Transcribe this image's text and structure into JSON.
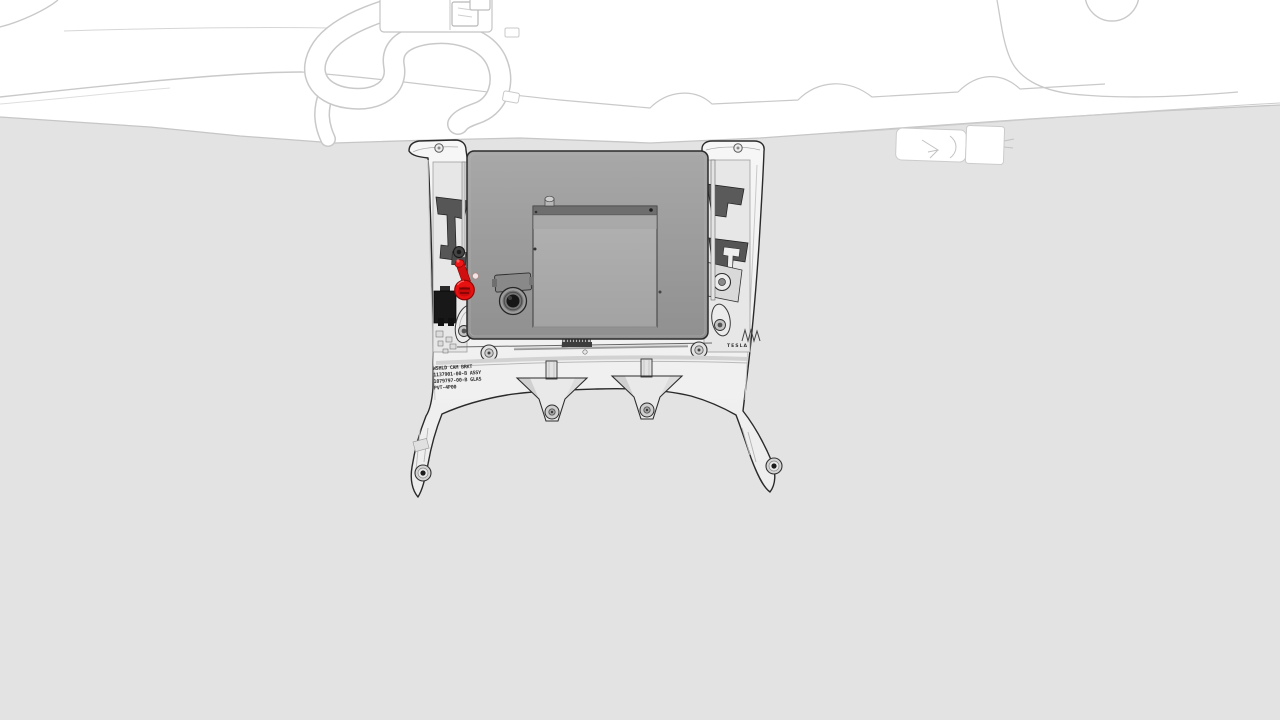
{
  "illustration": {
    "brand_text": "TESLA",
    "bracket_label": {
      "line1": "WSHLD CAM BRKT",
      "line2": "1137901-00-B ASSY",
      "line3": "1079797-00-B GLAS",
      "line4": "PVT-4P00"
    },
    "colors": {
      "background": "#ffffff",
      "windshield_gray": "#e3e3e3",
      "lineart_gray": "#c9c9c9",
      "bracket_white": "#f3f3f3",
      "module_gray": "#9d9d9d",
      "lid_gray": "#adadad",
      "outline_dark": "#2a2a2a",
      "highlight_red": "#e81111"
    },
    "parts": {
      "bracket": "windshield-camera-bracket",
      "module": "camera-module-housing",
      "lens": "forward-camera-lens",
      "highlighted_fastener": "red-highlighted-bolt",
      "harness": "headliner-wiring-harness"
    }
  }
}
